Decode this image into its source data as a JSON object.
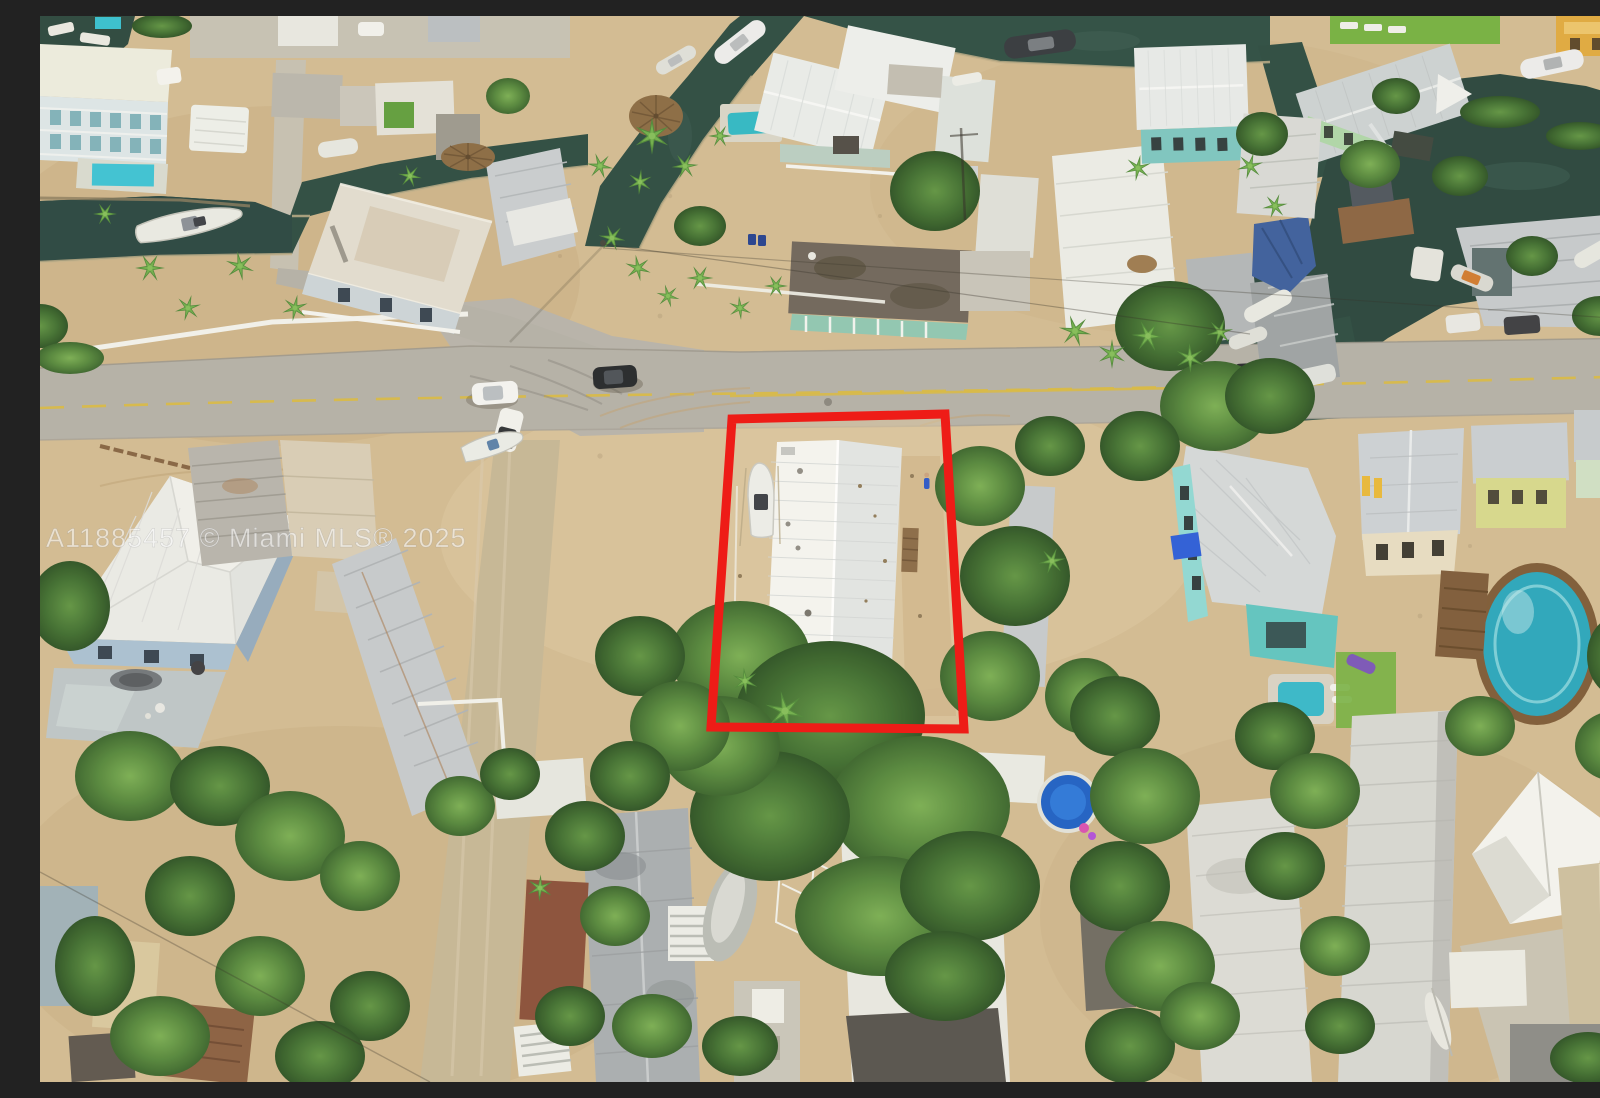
{
  "watermark": {
    "text": "A11885457 © Miami MLS® 2025",
    "color": "rgba(252,252,252,0.58)",
    "font_size": "27"
  },
  "property_outline": {
    "points": "692,403 905,398 924,713 671,711",
    "color": "#ee1c17",
    "stroke_width": "9",
    "label": "subject-property-boundary"
  },
  "palette": {
    "sand": "#d2bb92",
    "asphalt": "#b4b0a7",
    "canal_water": "#2b4a40",
    "tree_green": "#3f6f30",
    "roof_white": "#f1f1ed",
    "roof_silver": "#c9cdd0",
    "accent_red": "#ee1c17"
  },
  "scene": {
    "type": "aerial-photograph",
    "subject": "Florida Keys waterfront neighborhood of mobile homes and stilt houses with canals, boats, palms and a road; red rectangle annotation marks the listed lot with a white metal-roof home"
  }
}
